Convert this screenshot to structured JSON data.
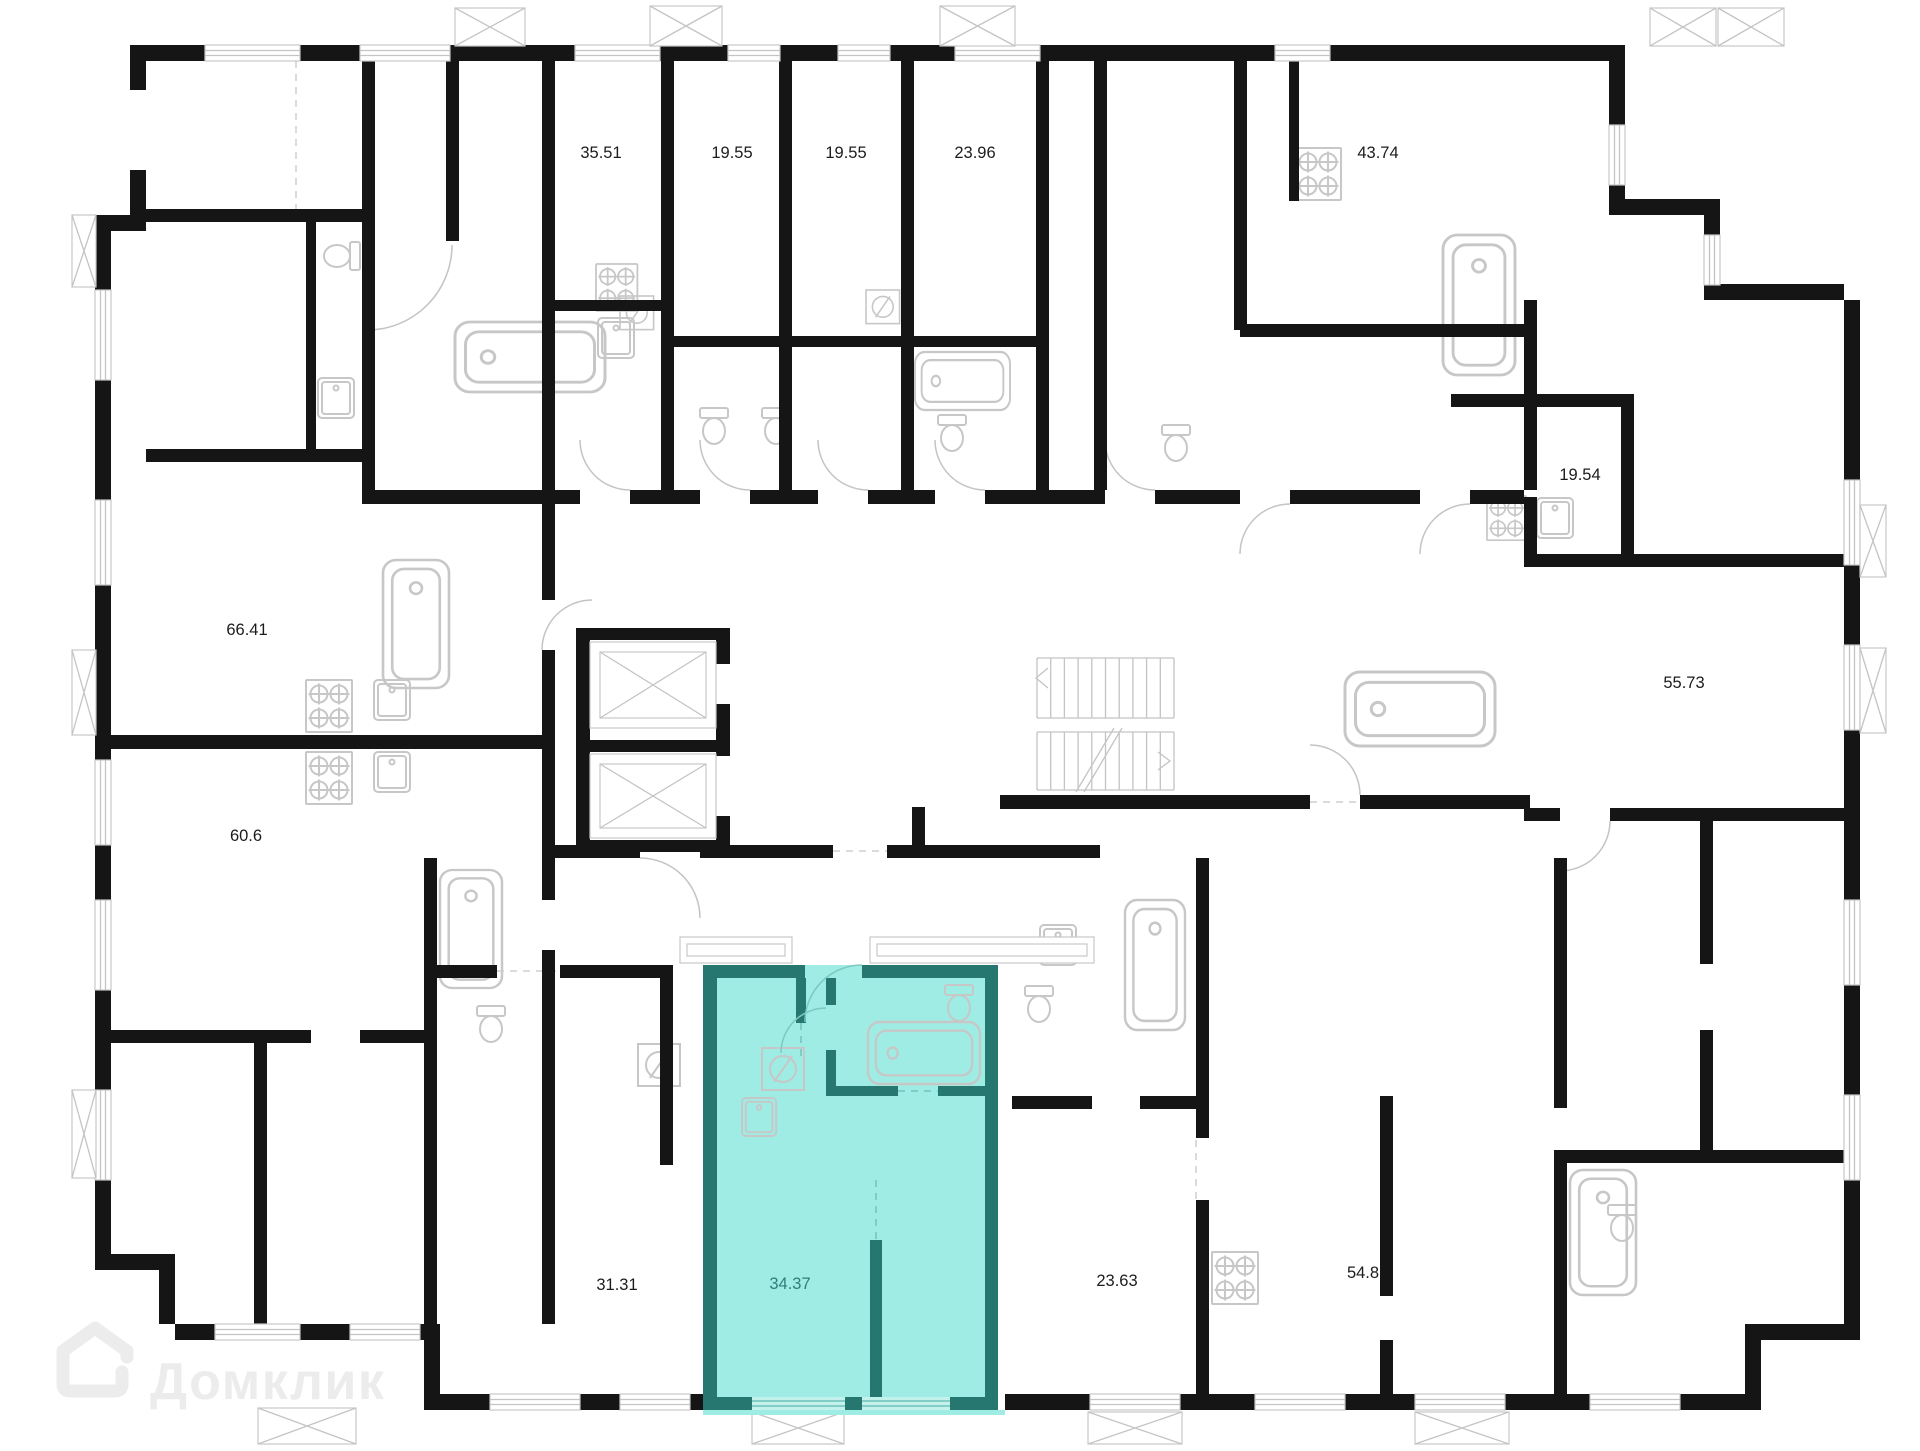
{
  "title": "Floor plan with highlighted apartment",
  "watermark": {
    "text": "Домклик",
    "logo": "domclick-house-logo"
  },
  "units": [
    {
      "name": "unit-35.51",
      "area_m2": "35.51",
      "highlighted": false
    },
    {
      "name": "unit-19.55-a",
      "area_m2": "19.55",
      "highlighted": false
    },
    {
      "name": "unit-19.55-b",
      "area_m2": "19.55",
      "highlighted": false
    },
    {
      "name": "unit-23.96",
      "area_m2": "23.96",
      "highlighted": false
    },
    {
      "name": "unit-43.74",
      "area_m2": "43.74",
      "highlighted": false
    },
    {
      "name": "unit-19.54",
      "area_m2": "19.54",
      "highlighted": false
    },
    {
      "name": "unit-66.41",
      "area_m2": "66.41",
      "highlighted": false
    },
    {
      "name": "unit-55.73",
      "area_m2": "55.73",
      "highlighted": false
    },
    {
      "name": "unit-60.6",
      "area_m2": "60.6",
      "highlighted": false
    },
    {
      "name": "unit-31.31",
      "area_m2": "31.31",
      "highlighted": false
    },
    {
      "name": "unit-34.37",
      "area_m2": "34.37",
      "highlighted": true
    },
    {
      "name": "unit-23.63",
      "area_m2": "23.63",
      "highlighted": false
    },
    {
      "name": "unit-54.8",
      "area_m2": "54.8",
      "highlighted": false
    }
  ],
  "icons": [
    "bathtub-icon",
    "toilet-icon",
    "sink-icon",
    "stove-icon",
    "electric-panel-icon",
    "elevator-shaft-icon",
    "staircase-icon",
    "window-icon",
    "balcony-icon",
    "door-arc-icon",
    "domclick-house-logo"
  ],
  "colors": {
    "wall": "#151515",
    "fixture": "#c7c7c7",
    "label": "#1c1c1c",
    "highlight_fill": "#9fece4",
    "highlight_wall": "#26776f",
    "highlight_fixture": "#58b7ae",
    "highlight_label": "#2d7f78",
    "window_band": "#c3f2ec",
    "watermark": "#ececec"
  }
}
